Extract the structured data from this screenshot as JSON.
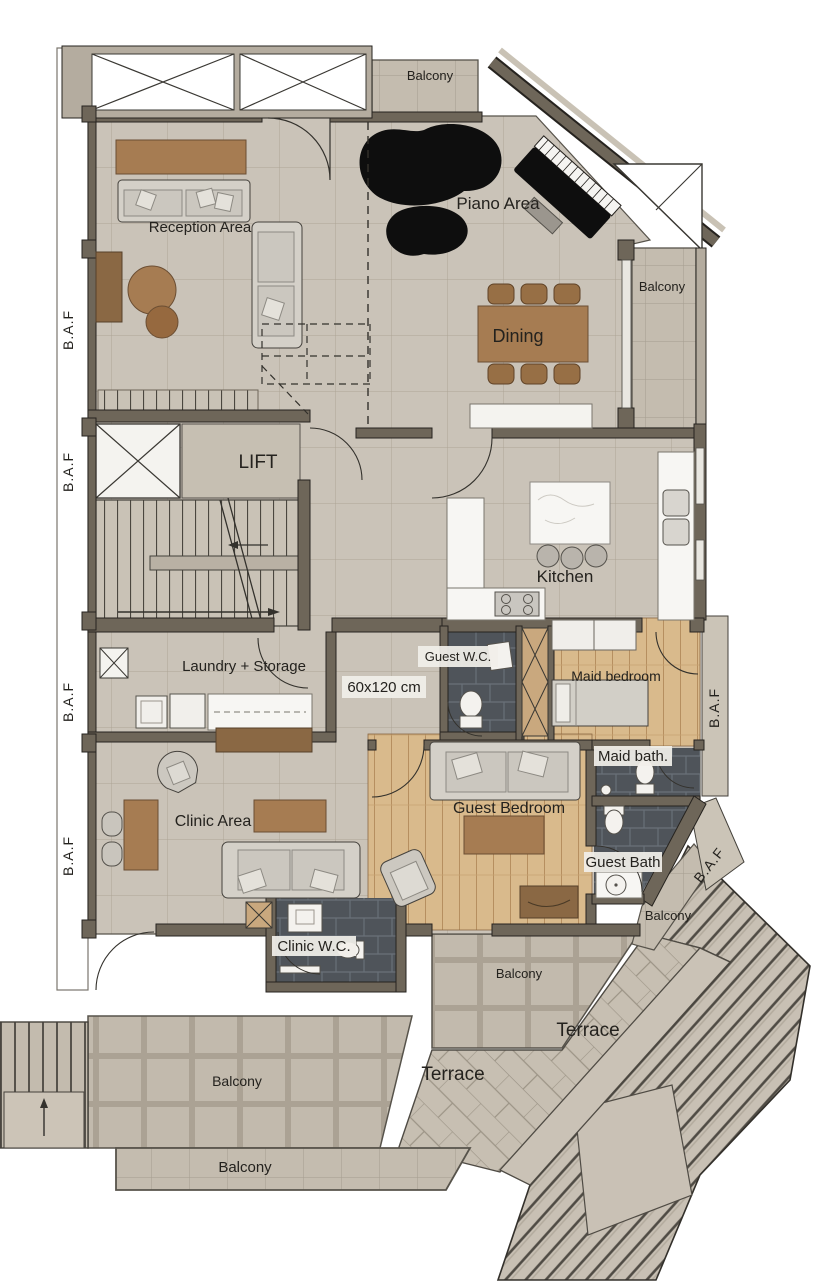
{
  "plan": {
    "type": "architectural-floor-plan",
    "labels": {
      "balcony": "Balcony",
      "terrace": "Terrace",
      "baf": "B.A.F",
      "reception": "Reception Area",
      "piano": "Piano Area",
      "dining": "Dining",
      "lift": "LIFT",
      "kitchen": "Kitchen",
      "laundry": "Laundry + Storage",
      "guest_wc": "Guest W.C.",
      "tile_size": "60x120 cm",
      "maid_bedroom": "Maid bedroom",
      "maid_bath": "Maid bath.",
      "guest_bedroom": "Guest Bedroom",
      "clinic": "Clinic Area",
      "guest_bath": "Guest Bath",
      "clinic_wc": "Clinic W.C."
    },
    "colors": {
      "wall": "#6e6659",
      "floor_tile": "#cac3b8",
      "balcony_tile": "#c4bcaf",
      "wood_floor": "#d9ba8c",
      "bath_tile": "#4f545a",
      "furniture_wood": "#a67c52",
      "piano_black": "#0e0e0e",
      "paper": "#ffffff"
    }
  }
}
